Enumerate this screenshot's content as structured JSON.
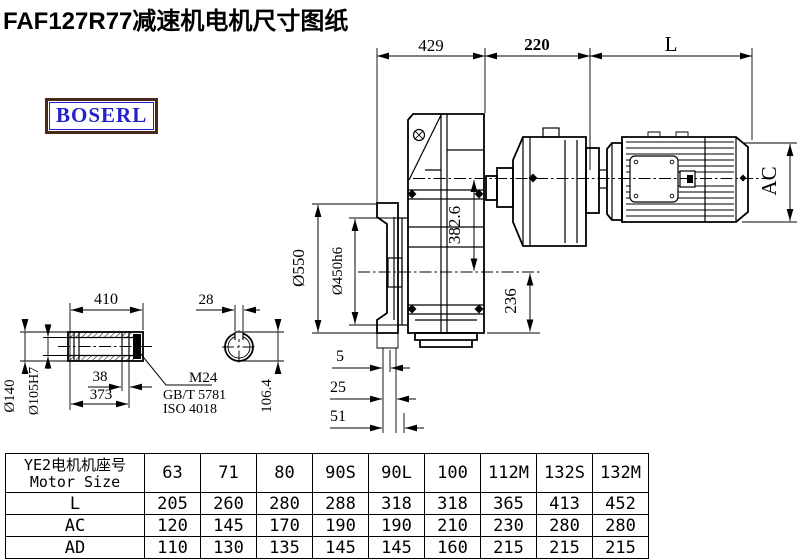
{
  "title": "FAF127R77减速机电机尺寸图纸",
  "logo": "BOSERL",
  "colors": {
    "logo_text": "#2222cc",
    "logo_border": "#4a2a1e",
    "line": "#000000"
  },
  "drawing": {
    "dims": {
      "top_width": "429",
      "mid_width": "220",
      "motor_length": "L",
      "motor_height": "AC",
      "flange_od": "Ø550",
      "spigot_od": "Ø450h6",
      "axis_distance": "382.6",
      "bottom_height": "236",
      "offset1": "5",
      "offset2": "25",
      "offset3": "51",
      "hub_length": "410",
      "hub_od": "Ø140",
      "bore": "Ø105H7",
      "groove_width": "38",
      "hub_length2": "373",
      "key_width": "28",
      "key_height": "106.4",
      "tap": "M24",
      "std1": "GB/T 5781",
      "std2": "ISO 4018"
    }
  },
  "table": {
    "header_zh": "YE2电机机座号",
    "header_en": "Motor Size",
    "sizes": [
      "63",
      "71",
      "80",
      "90S",
      "90L",
      "100",
      "112M",
      "132S",
      "132M"
    ],
    "rows": [
      {
        "label": "L",
        "values": [
          "205",
          "260",
          "280",
          "288",
          "318",
          "318",
          "365",
          "413",
          "452"
        ]
      },
      {
        "label": "AC",
        "values": [
          "120",
          "145",
          "170",
          "190",
          "190",
          "210",
          "230",
          "280",
          "280"
        ]
      },
      {
        "label": "AD",
        "values": [
          "110",
          "130",
          "135",
          "145",
          "145",
          "160",
          "215",
          "215",
          "215"
        ]
      }
    ]
  }
}
